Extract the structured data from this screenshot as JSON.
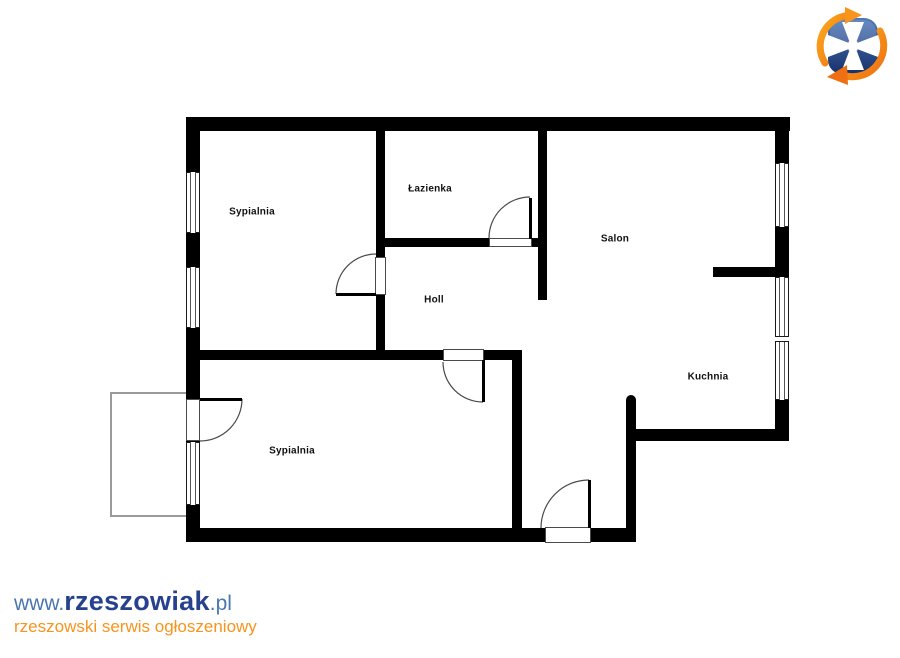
{
  "page": {
    "background": "#ffffff"
  },
  "floorplan": {
    "rooms": [
      {
        "id": "sypialnia-1",
        "label": "Sypialnia"
      },
      {
        "id": "lazienka",
        "label": "Łazienka"
      },
      {
        "id": "holl",
        "label": "Holl"
      },
      {
        "id": "salon",
        "label": "Salon"
      },
      {
        "id": "kuchnia",
        "label": "Kuchnia"
      },
      {
        "id": "sypialnia-2",
        "label": "Sypialnia"
      }
    ],
    "wall_color": "#000000",
    "balcony_border_color": "#9a9a9a"
  },
  "branding": {
    "logo": {
      "icon": "rzeszow-shield-cross-logo",
      "shield_color": "#24479b",
      "cross_color": "#ffffff",
      "arrow_color": "#f7941d"
    },
    "watermark": {
      "url_prefix": "www.",
      "site_name": "rzeszowiak",
      "url_suffix": ".pl",
      "tagline": "rzeszowski serwis ogłoszeniowy",
      "name_color": "#27418e",
      "affix_color": "#4a77ae",
      "tagline_color": "#f7941d"
    }
  }
}
